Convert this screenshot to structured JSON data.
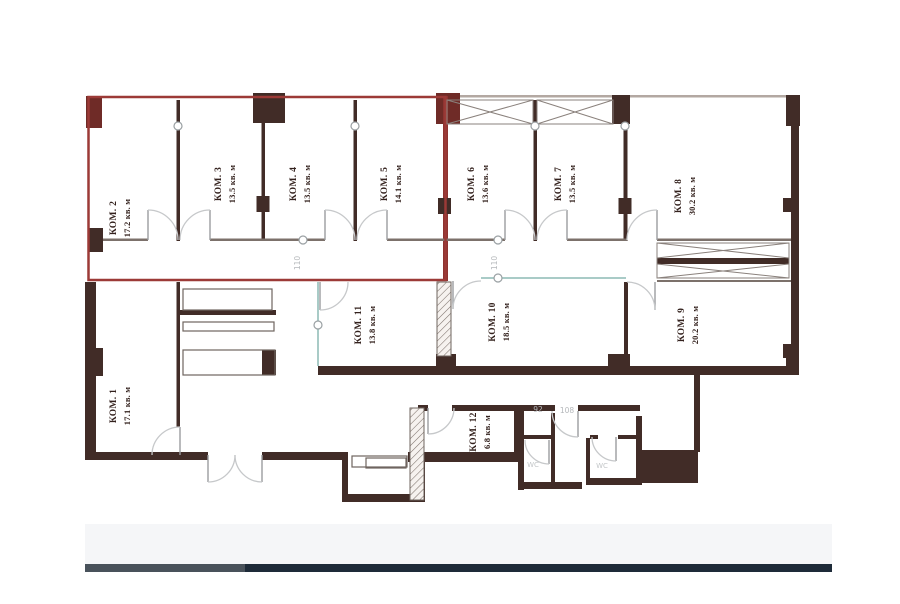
{
  "plan": {
    "rooms": [
      {
        "name": "КОМ. 1",
        "area": "17.1 кв. м"
      },
      {
        "name": "КОМ. 2",
        "area": "17.2 кв. м"
      },
      {
        "name": "КОМ. 3",
        "area": "13.5 кв. м"
      },
      {
        "name": "КОМ. 4",
        "area": "13.5 кв. м"
      },
      {
        "name": "КОМ. 5",
        "area": "14.1 кв. м"
      },
      {
        "name": "КОМ. 6",
        "area": "13.6 кв. м"
      },
      {
        "name": "КОМ. 7",
        "area": "13.5 кв. м"
      },
      {
        "name": "КОМ. 8",
        "area": "30.2 кв. м"
      },
      {
        "name": "КОМ. 9",
        "area": "20.2 кв. м"
      },
      {
        "name": "КОМ. 10",
        "area": "18.5 кв. м"
      },
      {
        "name": "КОМ. 11",
        "area": "13.8 кв. м"
      },
      {
        "name": "КОМ. 12",
        "area": "6.8 кв. м"
      }
    ],
    "corridor_number_left": "110",
    "corridor_number_right": "110",
    "room_number_92": "92",
    "room_number_108": "108",
    "wc_left": "WC",
    "wc_right": "WC",
    "colors": {
      "wall": "#412c27",
      "highlight_red": "#9c3a37",
      "red_wall": "#8e3330",
      "teal_partition": "#a9cbc7",
      "muted_text": "#b5b8bb",
      "bar_navy": "#1e2b39",
      "bar_gray": "#49525b"
    }
  }
}
